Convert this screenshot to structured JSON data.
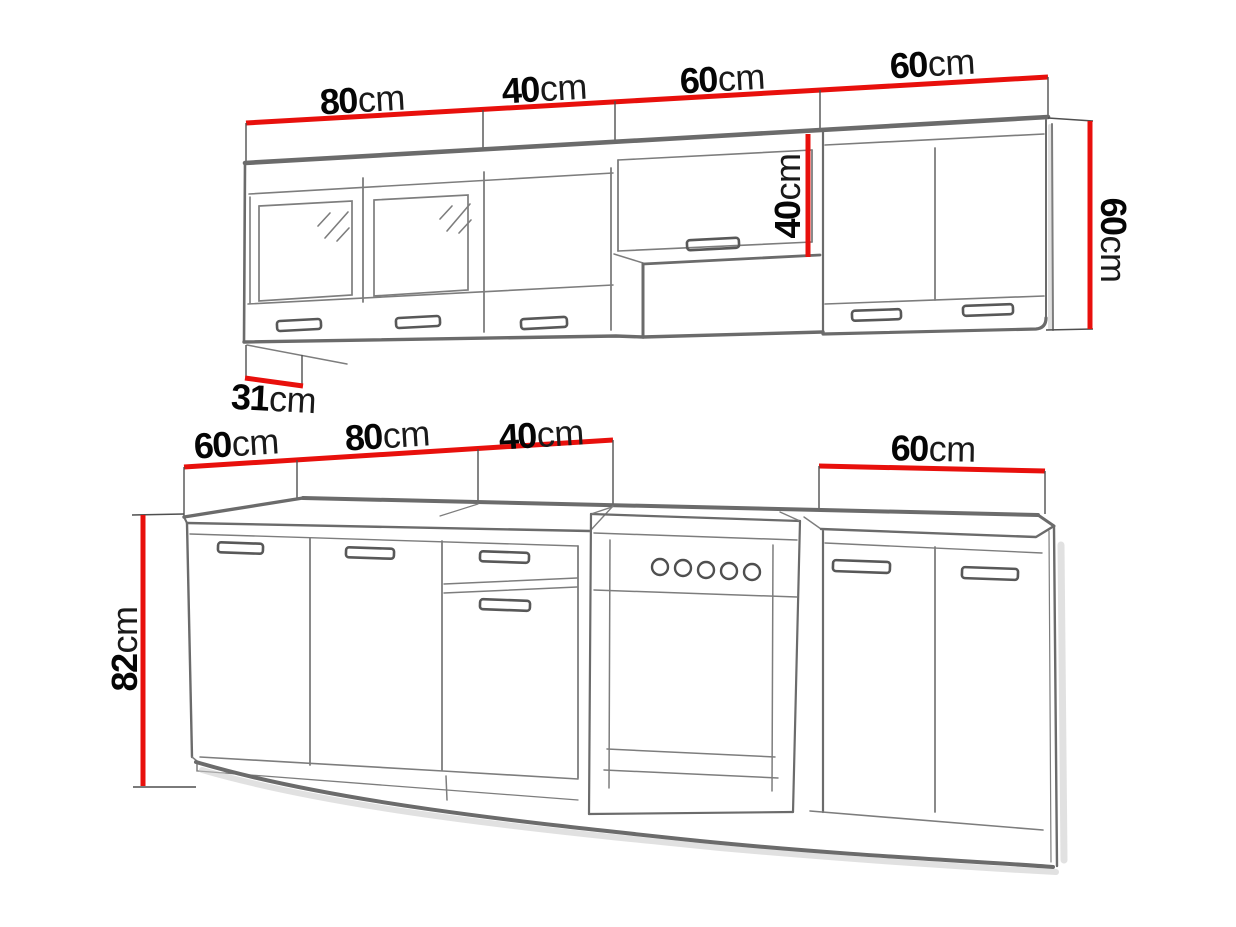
{
  "diagram": {
    "type": "kitchen-cabinet-set-dimension-drawing",
    "colors": {
      "dimension_red": "#e8100c",
      "line_gray": "#6b6b6b",
      "text": "#050505"
    }
  },
  "labels": {
    "wall_width_80": {
      "value": "80",
      "unit": "cm"
    },
    "wall_width_40": {
      "value": "40",
      "unit": "cm"
    },
    "wall_width_60a": {
      "value": "60",
      "unit": "cm"
    },
    "wall_width_60b": {
      "value": "60",
      "unit": "cm"
    },
    "wall_hood_height": {
      "value": "40",
      "unit": "cm"
    },
    "wall_cabinet_height": {
      "value": "60",
      "unit": "cm"
    },
    "wall_cabinet_depth": {
      "value": "31",
      "unit": "cm"
    },
    "base_worktop_depth": {
      "value": "60",
      "unit": "cm"
    },
    "base_width_80": {
      "value": "80",
      "unit": "cm"
    },
    "base_width_40": {
      "value": "40",
      "unit": "cm"
    },
    "base_width_60": {
      "value": "60",
      "unit": "cm"
    },
    "base_height_82": {
      "value": "82",
      "unit": "cm"
    }
  }
}
